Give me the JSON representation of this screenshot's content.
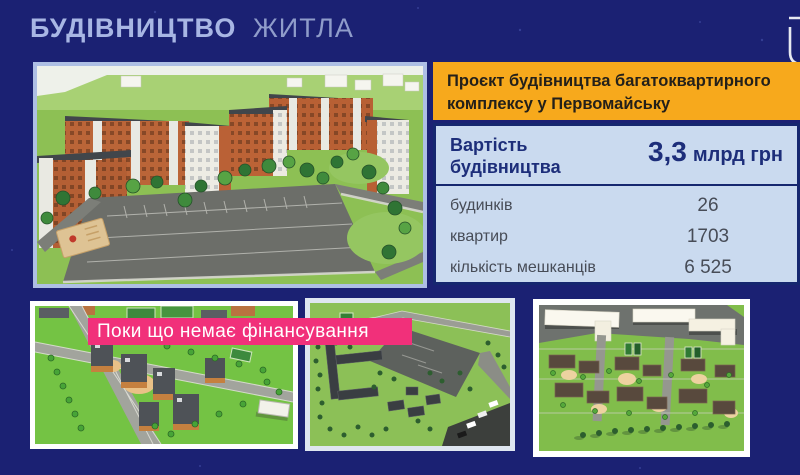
{
  "header": {
    "title_bold": "БУДІВНИЦТВО",
    "title_light": "ЖИТЛА"
  },
  "project_banner": {
    "text": "Проєкт будівництва багатоквартирного комплексу у Первомайську"
  },
  "stats_panel": {
    "cost_label": "Вартість будівництва",
    "cost_value": "3,3",
    "cost_unit": "млрд грн",
    "rows": [
      {
        "label": "будинків",
        "value": "26"
      },
      {
        "label": "квартир",
        "value": "1703"
      },
      {
        "label": "кількість мешканців",
        "value": "6 525"
      }
    ]
  },
  "status_banner": {
    "text": "Поки що немає фінансування"
  },
  "icons": {
    "corner_emblem": "partial-white-shield-outline"
  },
  "colors": {
    "background": "#1b2173",
    "title_bold": "#a8b6e4",
    "title_light": "#8f9cca",
    "banner_orange": "#f7a91c",
    "banner_pink": "#f1307a",
    "panel_bg": "#cadaef",
    "panel_border": "#16276f",
    "panel_text_navy": "#1d2e7a",
    "panel_text_gray": "#474c57",
    "main_frame_border": "#aebfe4",
    "bottom_frame_white": "#ffffff"
  }
}
